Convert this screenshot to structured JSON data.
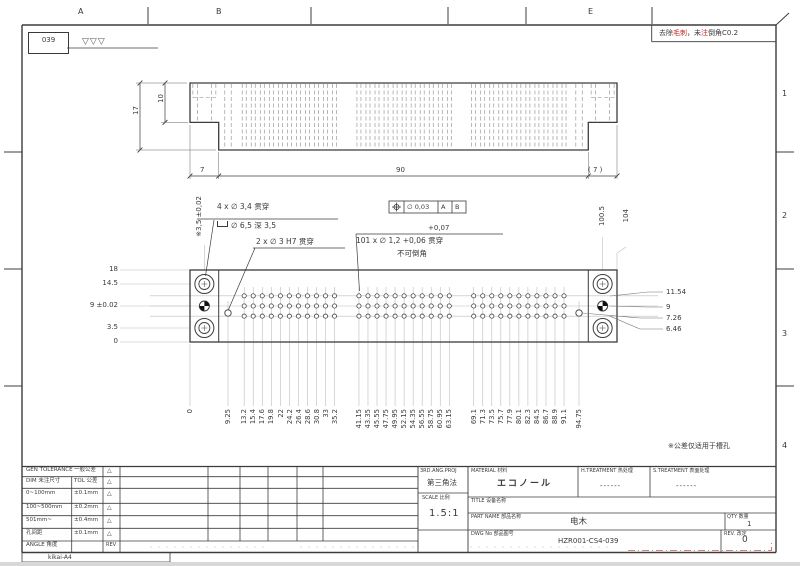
{
  "sheet": {
    "stamp": "039",
    "finish_symbols": "▽▽▽",
    "top_note_segments": [
      {
        "text": "去除",
        "red": false
      },
      {
        "text": "毛刺",
        "red": true
      },
      {
        "text": "，未",
        "red": false
      },
      {
        "text": "注",
        "red": true
      },
      {
        "text": "倒角C0.2",
        "red": false
      }
    ],
    "footnote": "※公差仅适用于槽孔",
    "zone_letters": [
      "A",
      "B",
      "E"
    ],
    "zone_numbers": [
      "1",
      "2",
      "3",
      "4"
    ],
    "paper_code": "kikai-A4"
  },
  "top_view": {
    "dim_height": "17",
    "dim_step_height": "10",
    "dim_left_step": "7",
    "dim_body": "90",
    "dim_right_step": "( 7 )"
  },
  "front_view": {
    "callout_cbore_line1": "4 x ∅ 3,4 贯穿",
    "callout_cbore_line2": "∅ 6,5 深 3,5",
    "callout_h7": "2 x ∅ 3 H7 贯穿",
    "callout_small_upper_tol": "+0,07",
    "callout_small": "101 x ∅ 1,2 +0,06 贯穿",
    "callout_no_chamfer": "不可倒角",
    "position_tolerance": {
      "value": "∅ 0,03",
      "datum_a": "A",
      "datum_b": "B"
    },
    "star_dim": "※3,5 ±0,02",
    "left_ordinates": [
      "18",
      "14.5",
      "9 ±0.02",
      "3.5",
      "0"
    ],
    "right_labels": [
      "11.54",
      "9",
      "7.26",
      "6.46"
    ],
    "top_ordinates": [
      "100.5",
      "104"
    ],
    "bottom_ordinates": [
      "0",
      "9.25",
      "13.2",
      "15.4",
      "17.6",
      "19.8",
      "22",
      "24.2",
      "26.4",
      "28.6",
      "30.8",
      "33",
      "35.2",
      "41.15",
      "43.35",
      "45.55",
      "47.75",
      "49.95",
      "52.15",
      "54.35",
      "56.55",
      "58.75",
      "60.95",
      "63.15",
      "69.1",
      "71.3",
      "73.5",
      "75.7",
      "77.9",
      "80.1",
      "82.3",
      "84.5",
      "86.7",
      "88.9",
      "91.1",
      "94.75"
    ]
  },
  "title_block": {
    "tolerance_table": {
      "rows": [
        {
          "c1": "GEN TOLERANCE",
          "c2": "一般公差"
        },
        {
          "c1": "DIM 未注尺寸",
          "c2": "TOL 公差"
        },
        {
          "c1": "0~100mm",
          "c2": "±0.1mm"
        },
        {
          "c1": "100~500mm",
          "c2": "±0.2mm"
        },
        {
          "c1": "501mm~",
          "c2": "±0.4mm"
        },
        {
          "c1": "孔间距",
          "c2": "±0.1mm"
        },
        {
          "c1": "ANGLE 角度",
          "c2": ""
        }
      ],
      "rev_label": "REV",
      "triangle_symbol": "△"
    },
    "projection_label": "3RD.ANG.PROJ",
    "projection_value": "第三角法",
    "scale_label": "SCALE 比例",
    "scale_value": "1.5:1",
    "material_label": "MATERIAL 材料",
    "material_value": "エコノール",
    "h_treatment_label": "H.TREATMENT 热处理",
    "h_treatment_value": "------",
    "s_treatment_label": "S.TREATMENT 表面处理",
    "s_treatment_value": "------",
    "title_label": "TITLE 设备名称",
    "part_name_label": "PART NAME 部品名称",
    "part_name_value": "电木",
    "qty_label": "QTY 数量",
    "qty_value": "1",
    "dwg_label": "DWG No 部品图号",
    "dwg_value": "HZR001-CS4-039",
    "rev_label": "REV. 改定",
    "rev_value": "0"
  }
}
